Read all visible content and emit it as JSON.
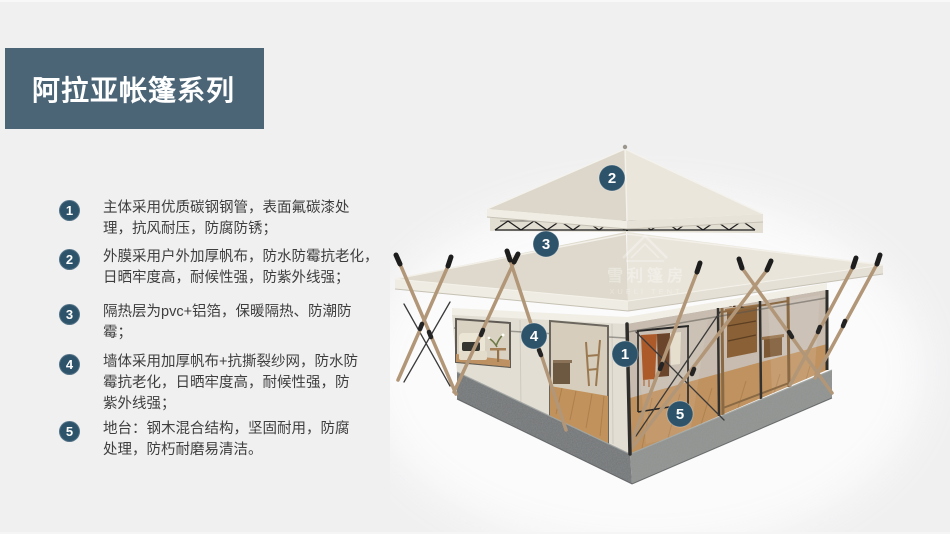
{
  "title": {
    "text": "阿拉亚帐篷系列"
  },
  "features": [
    {
      "num": "1",
      "text": "主体采用优质碳钢钢管，表面氟碳漆处\n理，抗风耐压，防腐防锈；"
    },
    {
      "num": "2",
      "text": "外膜采用户外加厚帆布，防水防霉抗老化，\n日晒牢度高，耐候性强，防紫外线强；"
    },
    {
      "num": "3",
      "text": "隔热层为pvc+铝箔，保暖隔热、防潮防\n霉；"
    },
    {
      "num": "4",
      "text": "墙体采用加厚帆布+抗撕裂纱网，防水防\n霉抗老化，日晒牢度高，耐候性强，防\n紫外线强；"
    },
    {
      "num": "5",
      "text": "地台：钢木混合结构，坚固耐用，防腐\n处理，防朽耐磨易清洁。"
    }
  ],
  "diagram": {
    "markers": [
      {
        "num": "2",
        "part": "top-roof"
      },
      {
        "num": "3",
        "part": "main-roof"
      },
      {
        "num": "4",
        "part": "canvas-wall"
      },
      {
        "num": "1",
        "part": "steel-frame"
      },
      {
        "num": "5",
        "part": "deck-platform"
      }
    ],
    "watermark": {
      "cn": "雪利篷房",
      "en": "XUELI TENT"
    }
  },
  "colors": {
    "accent": "#2d536b",
    "title_bg": "#4b6577",
    "background": "#f0f0f1"
  }
}
